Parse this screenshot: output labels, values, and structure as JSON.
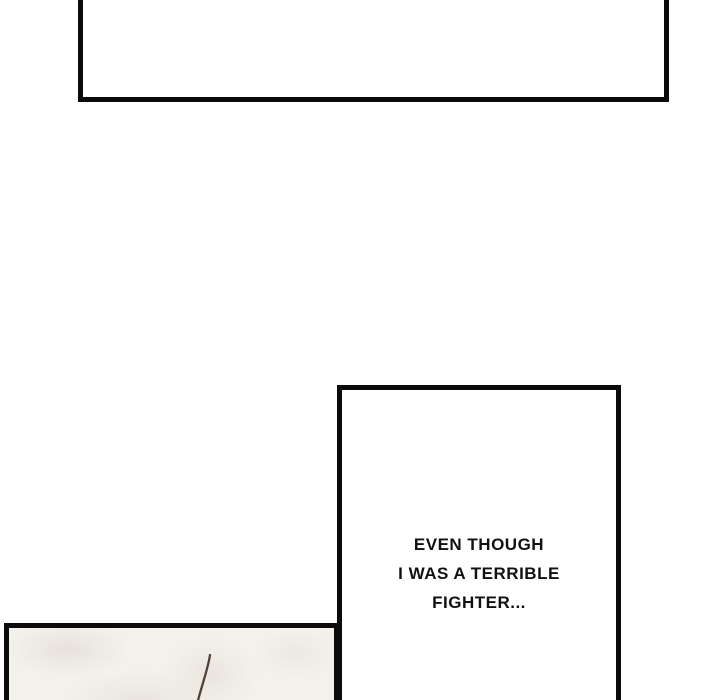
{
  "dialogue": {
    "lines": [
      "EVEN THOUGH",
      "I WAS A TERRIBLE",
      "FIGHTER..."
    ]
  },
  "colors": {
    "page_bg": "#ffffff",
    "panel_border": "#0b0b0b",
    "panel_bg": "#ffffff",
    "paper_bg": "#f4f1ec",
    "stick_color": "#4f4237",
    "text_color": "#111111"
  }
}
